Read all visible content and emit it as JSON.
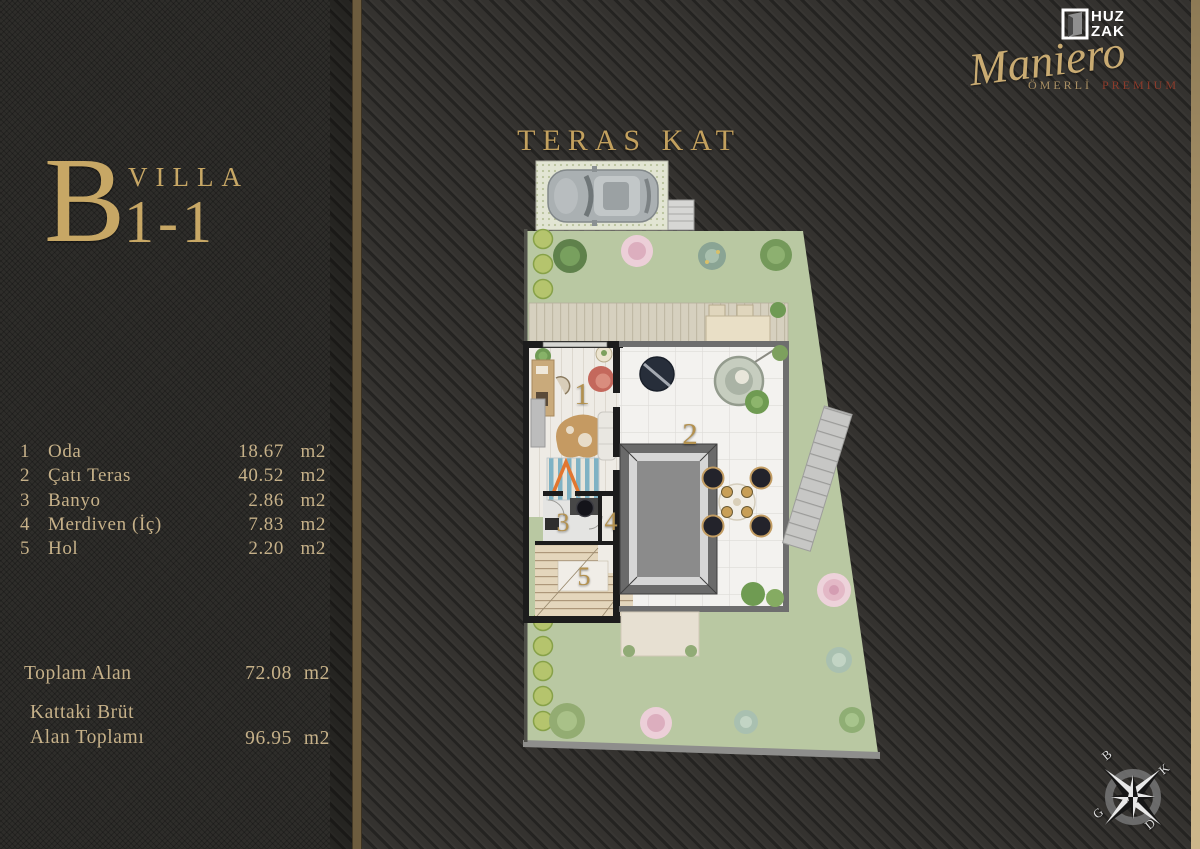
{
  "brand": {
    "logo_line1": "HUZ",
    "logo_line2": "ZAK",
    "name_script": "Maniero",
    "location": "ÖMERLİ",
    "tier": "PREMIUM"
  },
  "villa": {
    "block": "B",
    "type": "VILLA",
    "unit": "1-1"
  },
  "plan": {
    "title": "TERAS KAT"
  },
  "rooms": [
    {
      "no": "1",
      "name": "Oda",
      "area": "18.67",
      "unit": "m2"
    },
    {
      "no": "2",
      "name": "Çatı Teras",
      "area": "40.52",
      "unit": "m2"
    },
    {
      "no": "3",
      "name": "Banyo",
      "area": "2.86",
      "unit": "m2"
    },
    {
      "no": "4",
      "name": "Merdiven (İç)",
      "area": "7.83",
      "unit": "m2"
    },
    {
      "no": "5",
      "name": "Hol",
      "area": "2.20",
      "unit": "m2"
    }
  ],
  "totals": {
    "total_label": "Toplam Alan",
    "total_area": "72.08",
    "total_unit": "m2",
    "gross_label_line1": "Kattaki Brüt",
    "gross_label_line2": "Alan Toplamı",
    "gross_area": "96.95",
    "gross_unit": "m2"
  },
  "compass": {
    "north": "K",
    "south": "G",
    "east": "D",
    "west": "B"
  },
  "colors": {
    "gold": "#c7a766",
    "dark_red": "#8c3b2b",
    "lawn_green": "#b9c8a2"
  }
}
